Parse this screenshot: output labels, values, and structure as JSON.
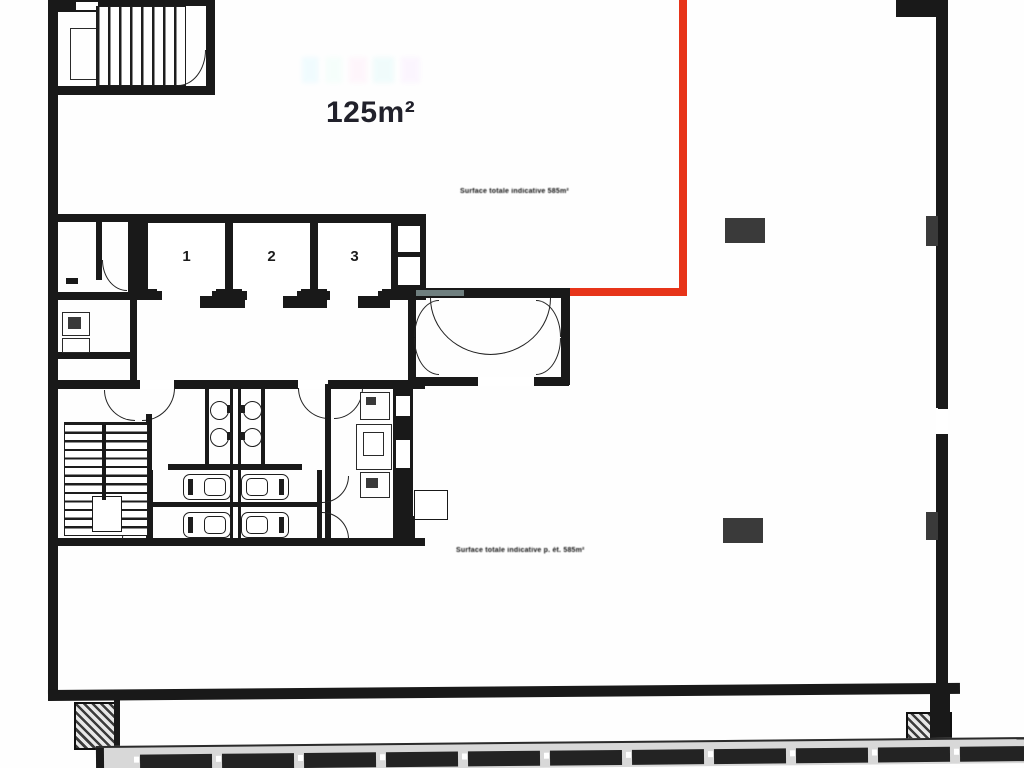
{
  "plan": {
    "title": "floor-plan",
    "area_label": "125m²",
    "elevators": [
      "1",
      "2",
      "3"
    ],
    "surface_note_top": "Surface totale indicative 585m²",
    "surface_note_bottom": "Surface totale indicative p. ét. 585m²",
    "colors": {
      "wall": "#191919",
      "red": "#e73419",
      "area-text": "#21212b",
      "column": "#3a3a3a",
      "facade-band": "#d8d8d8",
      "facade-panel": "#232323"
    }
  }
}
